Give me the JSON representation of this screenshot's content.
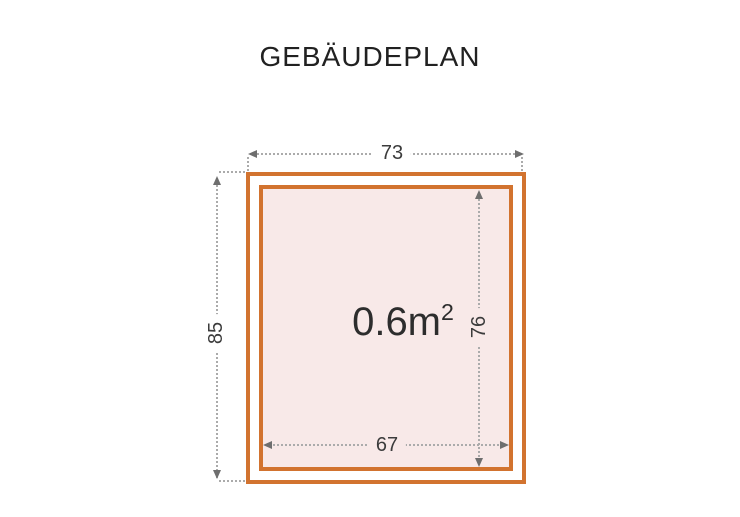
{
  "page": {
    "title": "GEBÄUDEPLAN"
  },
  "plan": {
    "area": {
      "value": "0.6m",
      "exponent": "2"
    },
    "dimensions": {
      "outer_width": "73",
      "outer_height": "85",
      "inner_height": "76",
      "inner_width": "67"
    },
    "colors": {
      "wall_orange": "#d2732f",
      "floor_pink": "#f8e9e8",
      "dim_line": "#ababab",
      "dim_arrow": "#6e6e6e",
      "dim_text": "#3c3c3c",
      "area_text": "#2d2d2d",
      "title_text": "#212121"
    }
  }
}
